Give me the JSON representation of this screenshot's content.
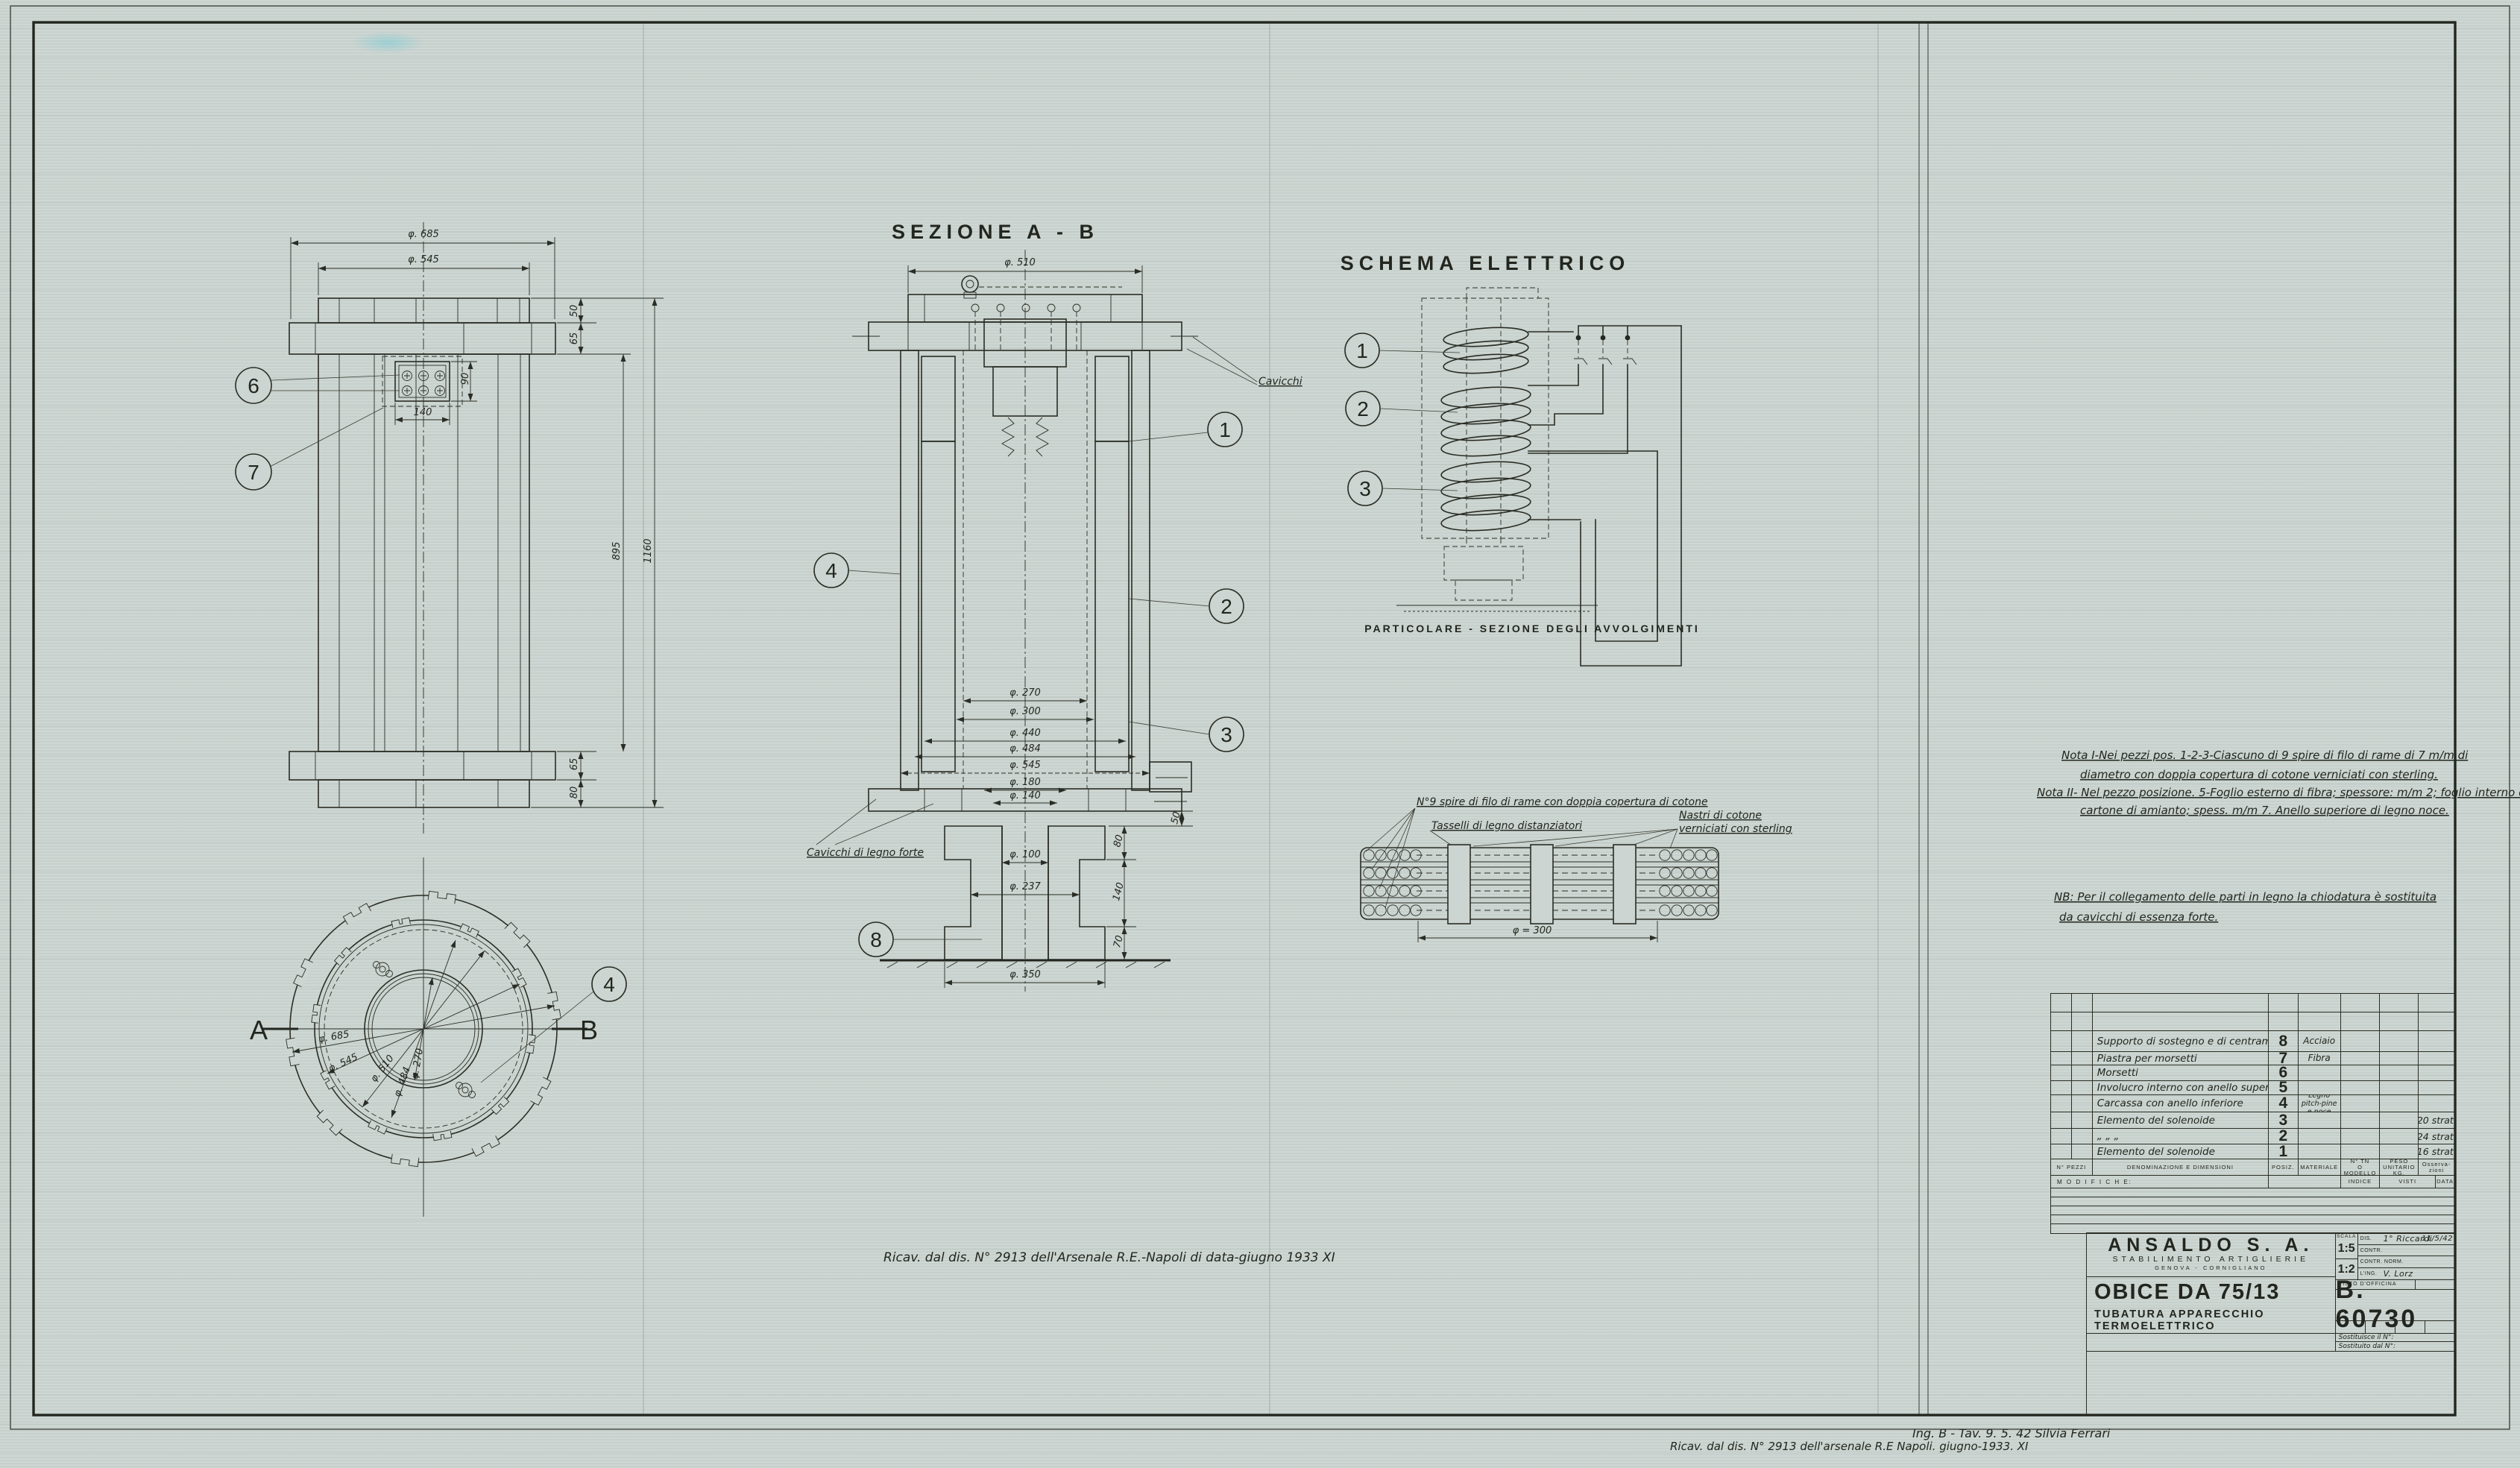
{
  "palette": {
    "paper": "#ccd5d1",
    "ink": "#22261f"
  },
  "front_view": {
    "dims": {
      "d685": "φ. 685",
      "d545": "φ. 545",
      "d50": "50",
      "d65": "65",
      "d90": "90",
      "d140": "140",
      "d895": "895",
      "d1160": "1160",
      "d65b": "65",
      "d80": "80"
    },
    "callouts": {
      "c6": "6",
      "c7": "7"
    }
  },
  "plan_view": {
    "section_a": "A",
    "section_b": "B",
    "callout_4": "4",
    "dims": {
      "d685": "φ. 685",
      "d545": "φ. 545",
      "d510": "φ. 510",
      "d484": "φ. 484",
      "d270": "φ. 270"
    }
  },
  "section_view": {
    "title": "SEZIONE  A - B",
    "callouts": {
      "c1": "1",
      "c2": "2",
      "c3": "3",
      "c4": "4",
      "c8": "8"
    },
    "labels": {
      "cavicchi": "Cavicchi",
      "cavicchi_legno": "Cavicchi di legno forte"
    },
    "dims": {
      "d510": "φ. 510",
      "d270": "φ. 270",
      "d300": "φ. 300",
      "d440": "φ. 440",
      "d484": "φ. 484",
      "d545": "φ. 545",
      "d180": "φ. 180",
      "d140": "φ. 140",
      "d100": "φ. 100",
      "d237": "φ. 237",
      "d350": "φ. 350",
      "d50": "50",
      "d80": "80",
      "d140r": "140",
      "d70": "70"
    }
  },
  "schema": {
    "title": "SCHEMA  ELETTRICO",
    "callouts": {
      "c1": "1",
      "c2": "2",
      "c3": "3"
    },
    "caption": "PARTICOLARE -   SEZIONE  DEGLI  AVVOLGIMENTI"
  },
  "winding_detail": {
    "label_spire": "N°9 spire di filo di rame con doppia copertura di cotone",
    "label_tasselli": "Tasselli di legno distanziatori",
    "label_nastri_1": "Nastri di cotone",
    "label_nastri_2": "verniciati con sterling",
    "dim_300": "φ = 300"
  },
  "notes": {
    "nota1_l1": "Nota I-Nei pezzi pos. 1-2-3-Ciascuno di 9 spire di filo di rame di 7 m/m di",
    "nota1_l2": "diametro con doppia copertura di cotone verniciati con sterling.",
    "nota2_l1": "Nota II- Nel pezzo posizione. 5-Foglio esterno di fibra; spessore: m/m 2; foglio interno di",
    "nota2_l2": "cartone di amianto; spess. m/m 7. Anello superiore di legno noce.",
    "nb_l1": "NB: Per il collegamento delle parti in legno la chiodatura è sostituita",
    "nb_l2": "da cavicchi di essenza forte."
  },
  "annotations": {
    "center_note": "Ricav. dal dis. N° 2913  dell'Arsenale  R.E.-Napoli  di data-giugno 1933 XI",
    "bottom_note": "Ricav. dal dis. N° 2913  dell'arsenale  R.E Napoli.   giugno-1933.  XI",
    "signature": "Ing. B - Tav. 9. 5. 42   Silvia Ferrari"
  },
  "parts_table": {
    "headers": {
      "pezzi": "N° PEZZI",
      "denominazione": "DENOMINAZIONE  E  DIMENSIONI",
      "posiz": "POSIZ.",
      "materiale": "MATERIALE",
      "modello_1": "N° TN",
      "modello_2": "O MODELLO",
      "peso_1": "PESO",
      "peso_2": "UNITARIO",
      "peso_3": "KG.",
      "oss_1": "Osserva-",
      "oss_2": "zioni"
    },
    "modifiche_row": {
      "modifiche": "M O D I F I C H E:",
      "indice": "INDICE",
      "visti": "VISTI",
      "data": "DATA"
    },
    "rows": [
      {
        "name": "Supporto di sostegno e di centramento",
        "pos": "8",
        "material": "Acciaio",
        "obs": ""
      },
      {
        "name": "Piastra per morsetti",
        "pos": "7",
        "material": "Fibra",
        "obs": ""
      },
      {
        "name": "Morsetti",
        "pos": "6",
        "material": "",
        "obs": ""
      },
      {
        "name": "Involucro interno con anello superiore",
        "pos": "5",
        "material": "",
        "obs": ""
      },
      {
        "name": "Carcassa con anello inferiore",
        "pos": "4",
        "material": "Legno pitch-pine",
        "material2": "e noce",
        "obs": ""
      },
      {
        "name": "Elemento del solenoide",
        "pos": "3",
        "material": "",
        "obs": "20 strati"
      },
      {
        "name": "„        „        „",
        "pos": "2",
        "material": "",
        "obs": "24 strati"
      },
      {
        "name": "Elemento del solenoide",
        "pos": "1",
        "material": "",
        "obs": "16 strati"
      }
    ]
  },
  "title_block": {
    "company": "ANSALDO  S. A.",
    "division": "STABILIMENTO  ARTIGLIERIE",
    "location": "GENOVA - CORNIGLIANO",
    "subject": "OBICE DA 75/13",
    "subtitle": "TUBATURA  APPARECCHIO  TERMOELETTRICO",
    "scala_label": "SCALA",
    "scale1": "1:5",
    "scale2": "1:2",
    "row_dis": "DIS.",
    "row_contr": "CONTR.",
    "row_contr_norm": "CONTR. NORM.",
    "row_ing": "L'ING.",
    "row_visto": "VISTO  D'OFFICINA",
    "dis_sign": "1° Riccardi",
    "dis_date": "11/5/42",
    "ing_sign": "V. Lorz",
    "drawing_number": "B. 60730",
    "sostituisce": "Sostituisce il N°:",
    "sostituito": "Sostituito dal N°:"
  }
}
